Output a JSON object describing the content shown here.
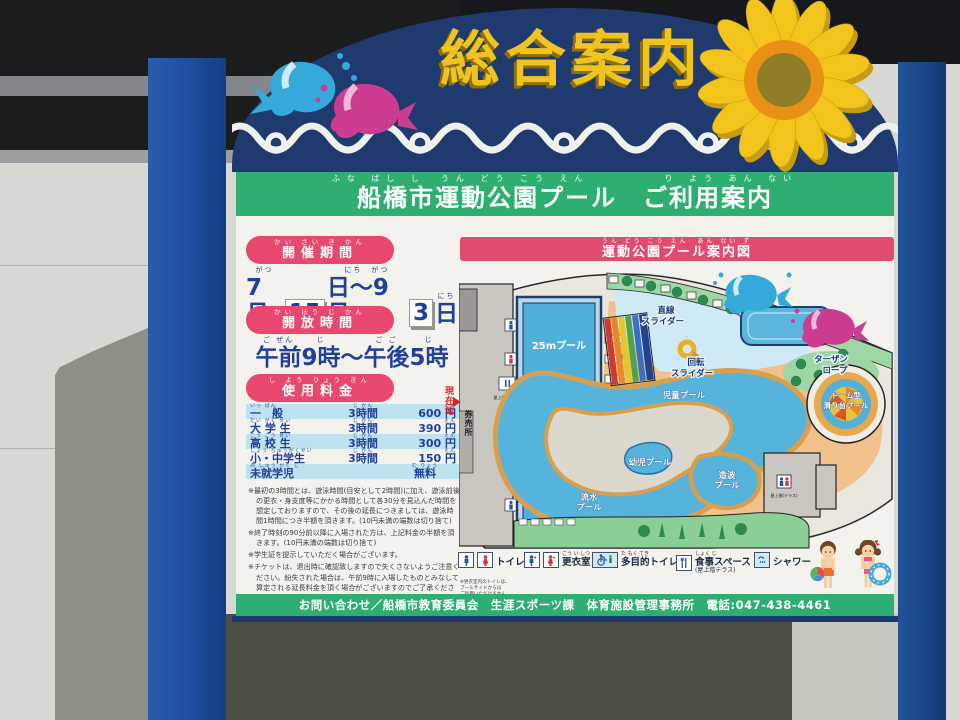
{
  "colors": {
    "arch_navy": "#1f3a6e",
    "bar_green": "#2fae72",
    "banner_pink": "#e8486e",
    "map_title_pink": "#e14b6d",
    "text_navy": "#21409a",
    "fee_row_blue": "#bfe2ef",
    "post_blue": "#1e4d9e",
    "title_yellow": "#f0c41e",
    "pool_blue": "#4fb0dc"
  },
  "header": {
    "title": "総合案内"
  },
  "board": {
    "furigana": "ふな ばし し　うん どう こう えん　　　　　り よう あん ない",
    "title": "船橋市運動公園プール　ご利用案内"
  },
  "period": {
    "label": "開催期間",
    "label_r": "かい さい き かん",
    "seg1": "7月",
    "seg1_r": "がつ",
    "tile1": "15",
    "seg2": "日〜9月",
    "seg2_r": "にち　がつ",
    "tile2": "3",
    "seg3": "日",
    "seg3_r": "にち"
  },
  "hours": {
    "label": "開放時間",
    "label_r": "かい ほう じ かん",
    "seg1": "午前",
    "seg1_r": "ご ぜん",
    "seg2": "9時",
    "seg2_r": "じ",
    "seg3": "〜",
    "seg3_r": "",
    "seg4": "午後",
    "seg4_r": "ご ご",
    "seg5": "5時",
    "seg5_r": "じ"
  },
  "fees": {
    "label": "使用料金",
    "label_r": "し よう りょう きん",
    "rows": [
      {
        "label": "一　般",
        "label_r": "いっ ぱん",
        "dur": "3時間",
        "dur_r": "じ かん",
        "price": "600 円",
        "price_r": "えん"
      },
      {
        "label": "大 学 生",
        "label_r": "だい がく せい",
        "dur": "3時間",
        "dur_r": "じ かん",
        "price": "390 円",
        "price_r": "えん"
      },
      {
        "label": "高 校 生",
        "label_r": "こう こう せい",
        "dur": "3時間",
        "dur_r": "じ かん",
        "price": "300 円",
        "price_r": "えん"
      },
      {
        "label": "小・中学生",
        "label_r": "しょう ちゅうがくせい",
        "dur": "3時間",
        "dur_r": "じ かん",
        "price": "150 円",
        "price_r": "えん"
      },
      {
        "label": "未就学児",
        "label_r": "み しゅう がく じ",
        "dur": "",
        "dur_r": "",
        "price": "無料",
        "price_r": "む りょう"
      }
    ]
  },
  "notes": [
    "※最初の3時間とは、遊泳時間(目安として2時間)に加え、遊泳前後の更衣・身支度等にかかる時間として各30分を見込んだ時間を想定しておりますので、その後の延長につきましては、遊泳時間1時間につき半額を頂きます。(10円未満の端数は切り捨て)",
    "※終了時刻の90分前以降に入場された方は、上記料金の半額を頂きます。(10円未満の端数は切り捨て)",
    "※学生証を提示していただく場合がございます。",
    "※チケットは、退出時に確認致しますので失くさないようご注意ください。紛失された場合は、午前9時に入場したものとみなして算定される延長料金を頂く場合がございますのでご了承ください。"
  ],
  "map": {
    "title": "運動公園プール案内図",
    "title_r": "うん どう こう えん　あん ない ず",
    "pool25": "25mプール",
    "pool50": "50mプール",
    "straight1": "直線",
    "straight2": "スライダー",
    "spiral1": "回転",
    "spiral2": "スライダー",
    "tarzan1": "ターザン",
    "tarzan2": "ロープ",
    "dome1": "ドーム型",
    "dome2": "滑り台プール",
    "child": "児童プール",
    "toddler": "幼児プール",
    "lazy1": "流水",
    "lazy2": "プール",
    "wave1": "造波",
    "wave2": "プール",
    "current": "現在地",
    "ticket": "券売所",
    "terrace": "屋上階(テラス)",
    "locker_small": "更衣室"
  },
  "legend": {
    "toilet": "トイレ",
    "locker": "更衣室",
    "locker_r": "こう い しつ",
    "multi": "多目的トイレ",
    "multi_r": "た もく てき",
    "meal": "食事スペース",
    "meal_r": "しょく じ",
    "meal_sub": "(屋上階テラス)",
    "shower": "シャワー",
    "note1": "※更衣室内のトイレは、",
    "note2": "プールサイドからは",
    "note3": "ご利用いただけません。"
  },
  "footer": {
    "contact": "お問い合わせ／船橋市教育委員会　生涯スポーツ課　体育施設管理事務所　電話:047-438-4461"
  }
}
